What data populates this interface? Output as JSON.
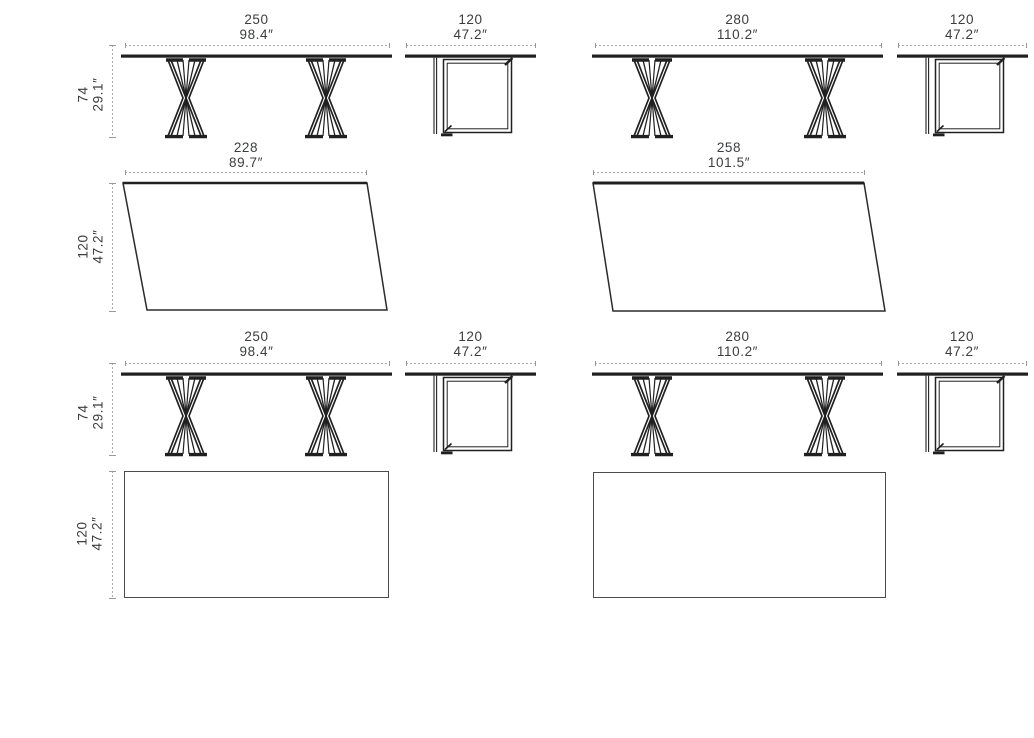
{
  "colors": {
    "drawing_line": "#202020",
    "dimension_line": "#a9abad",
    "text": "#3b3d3f",
    "top_view_outline": "#4a4d4f",
    "background": "#ffffff"
  },
  "views": {
    "row1": {
      "table_250_front": {
        "width_cm": "250",
        "width_in": "98.4″",
        "height_cm": "74",
        "height_in": "29.1″"
      },
      "table_250_side": {
        "depth_cm": "120",
        "depth_in": "47.2″"
      },
      "table_280_front": {
        "width_cm": "280",
        "width_in": "110.2″"
      },
      "table_280_side": {
        "depth_cm": "120",
        "depth_in": "47.2″"
      }
    },
    "row2": {
      "top_228": {
        "width_cm": "228",
        "width_in": "89.7″",
        "depth_cm": "120",
        "depth_in": "47.2″"
      },
      "top_258": {
        "width_cm": "258",
        "width_in": "101.5″"
      }
    },
    "row3": {
      "table_250_front": {
        "width_cm": "250",
        "width_in": "98.4″",
        "height_cm": "74",
        "height_in": "29.1″"
      },
      "table_250_side": {
        "depth_cm": "120",
        "depth_in": "47.2″"
      },
      "table_280_front": {
        "width_cm": "280",
        "width_in": "110.2″"
      },
      "table_280_side": {
        "depth_cm": "120",
        "depth_in": "47.2″"
      }
    },
    "row4": {
      "rect_top": {
        "depth_cm": "120",
        "depth_in": "47.2″"
      }
    }
  }
}
